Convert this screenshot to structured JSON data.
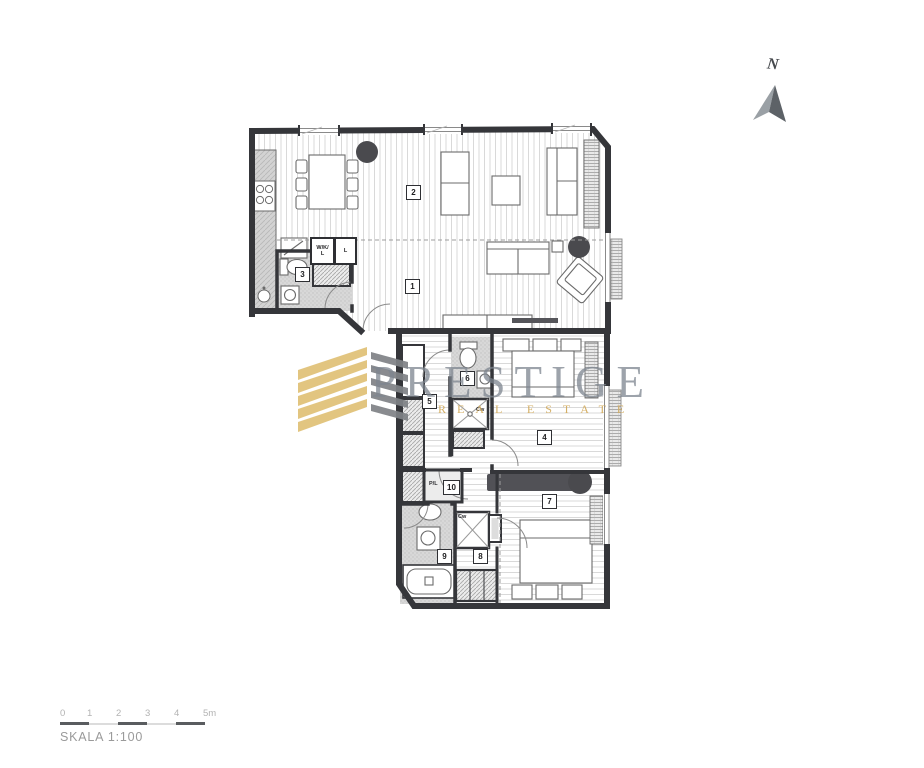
{
  "compass": {
    "label": "N"
  },
  "watermark": {
    "brand": "PRESTIGE",
    "tagline": "REAL ESTATE",
    "gold_color": "#e0c176",
    "gray_color": "#7f8286",
    "text_color": "#7d858f"
  },
  "plan": {
    "room_numbers": [
      "1",
      "2",
      "3",
      "4",
      "5",
      "6",
      "7",
      "8",
      "9",
      "10"
    ],
    "closet_labels": {
      "wkl_line1": "W/K/",
      "wkl_line2": "L",
      "linen": "L",
      "pl": "P/L"
    },
    "fixture_labels": {
      "shower": "Cw"
    },
    "colors": {
      "wall": "#35363a",
      "floor_stripe": "#d9d9d9",
      "bath_floor": "#d8d8d8",
      "column": "#4a4a4e"
    }
  },
  "scale_bar": {
    "ticks": [
      "0",
      "1",
      "2",
      "3",
      "4",
      "5m"
    ],
    "caption": "SKALA 1:100"
  }
}
